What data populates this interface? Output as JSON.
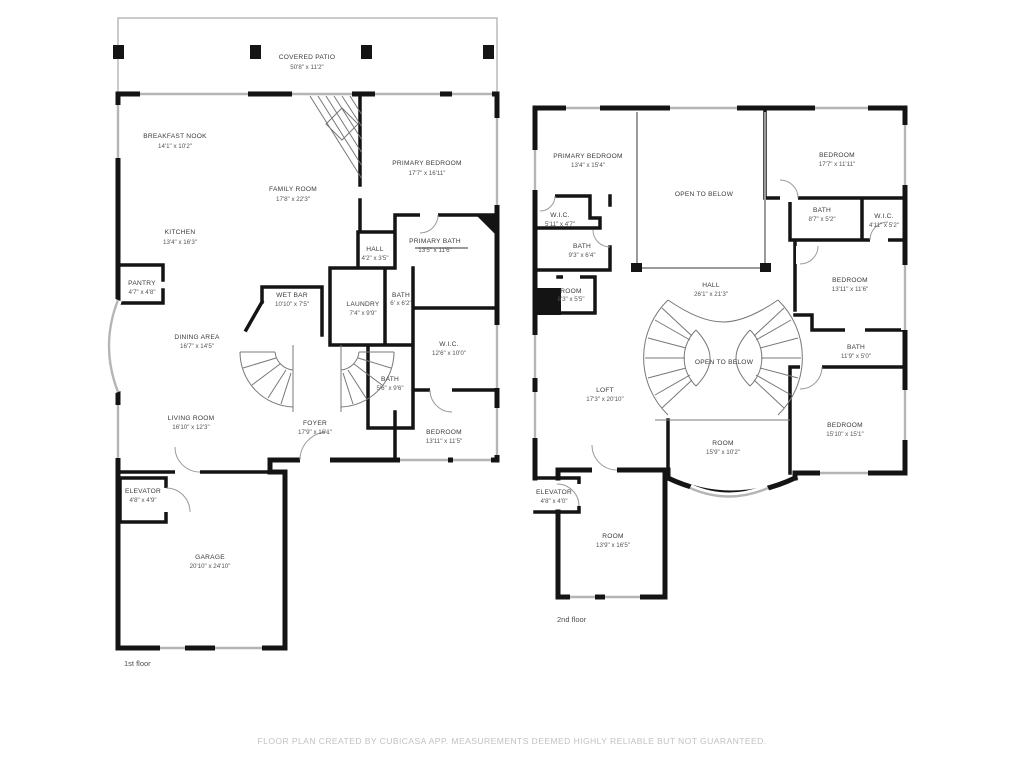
{
  "meta": {
    "type": "floor-plan",
    "creator_note_visible": true
  },
  "colors": {
    "wall": "#141414",
    "window": "#b5b5b5",
    "thin_line": "#9a9a9a",
    "stair_line": "#787878",
    "label_text": "#3a3a3a",
    "dims_text": "#555555",
    "footer_text": "#c2c2c2",
    "background": "#ffffff"
  },
  "floor1": {
    "label": "1st floor",
    "rooms": {
      "covered_patio": {
        "name": "COVERED PATIO",
        "dims": "50'8\" x 11'2\""
      },
      "breakfast_nook": {
        "name": "BREAKFAST NOOK",
        "dims": "14'1\" x 10'2\""
      },
      "family_room": {
        "name": "FAMILY ROOM",
        "dims": "17'8\" x 22'3\""
      },
      "primary_bedroom": {
        "name": "PRIMARY BEDROOM",
        "dims": "17'7\" x 16'11\""
      },
      "kitchen": {
        "name": "KITCHEN",
        "dims": "13'4\" x 16'3\""
      },
      "pantry": {
        "name": "PANTRY",
        "dims": "4'7\" x 4'8\""
      },
      "hall": {
        "name": "HALL",
        "dims": "4'2\" x 3'5\""
      },
      "primary_bath": {
        "name": "PRIMARY BATH",
        "dims": "13'5\" x 11'6\""
      },
      "wet_bar": {
        "name": "WET BAR",
        "dims": "10'10\" x 7'5\""
      },
      "laundry": {
        "name": "LAUNDRY",
        "dims": "7'4\" x 9'9\""
      },
      "bath_small": {
        "name": "BATH",
        "dims": "6' x 6'2\""
      },
      "dining_area": {
        "name": "DINING AREA",
        "dims": "16'7\" x 14'5\""
      },
      "wic": {
        "name": "W.I.C.",
        "dims": "12'6\" x 10'0\""
      },
      "bath": {
        "name": "BATH",
        "dims": "5'6\" x 9'6\""
      },
      "living_room": {
        "name": "LIVING ROOM",
        "dims": "16'10\" x 12'3\""
      },
      "foyer": {
        "name": "FOYER",
        "dims": "17'9\" x 16'1\""
      },
      "bedroom": {
        "name": "BEDROOM",
        "dims": "13'11\" x 11'5\""
      },
      "elevator": {
        "name": "ELEVATOR",
        "dims": "4'8\" x 4'9\""
      },
      "garage": {
        "name": "GARAGE",
        "dims": "20'10\" x 24'10\""
      }
    }
  },
  "floor2": {
    "label": "2nd floor",
    "rooms": {
      "primary_bedroom": {
        "name": "PRIMARY BEDROOM",
        "dims": "13'4\" x 15'4\""
      },
      "open_to_below_top": {
        "name": "OPEN TO BELOW"
      },
      "bedroom_tr": {
        "name": "BEDROOM",
        "dims": "17'7\" x 11'11\""
      },
      "wic_left": {
        "name": "W.I.C.",
        "dims": "5'11\" x 4'7\""
      },
      "bath_93": {
        "name": "BATH",
        "dims": "9'3\" x 6'4\""
      },
      "bath_87": {
        "name": "BATH",
        "dims": "8'7\" x 5'2\""
      },
      "wic_right": {
        "name": "W.I.C.",
        "dims": "4'11\" x 5'2\""
      },
      "room_83": {
        "name": "ROOM",
        "dims": "8'3\" x 5'5\""
      },
      "hall": {
        "name": "HALL",
        "dims": "26'1\" x 21'3\""
      },
      "bedroom_right": {
        "name": "BEDROOM",
        "dims": "13'11\" x 11'6\""
      },
      "open_to_below_center": {
        "name": "OPEN TO BELOW"
      },
      "bath_119": {
        "name": "BATH",
        "dims": "11'9\" x 5'0\""
      },
      "loft": {
        "name": "LOFT",
        "dims": "17'3\" x 20'10\""
      },
      "room_159": {
        "name": "ROOM",
        "dims": "15'9\" x 10'2\""
      },
      "bedroom_br": {
        "name": "BEDROOM",
        "dims": "15'10\" x 15'1\""
      },
      "elevator": {
        "name": "ELEVATOR",
        "dims": "4'8\" x 4'0\""
      },
      "room_139": {
        "name": "ROOM",
        "dims": "13'9\" x 16'5\""
      }
    }
  },
  "footer": {
    "text": "FLOOR PLAN CREATED BY CUBICASA APP. MEASUREMENTS DEEMED HIGHLY RELIABLE BUT NOT GUARANTEED."
  }
}
